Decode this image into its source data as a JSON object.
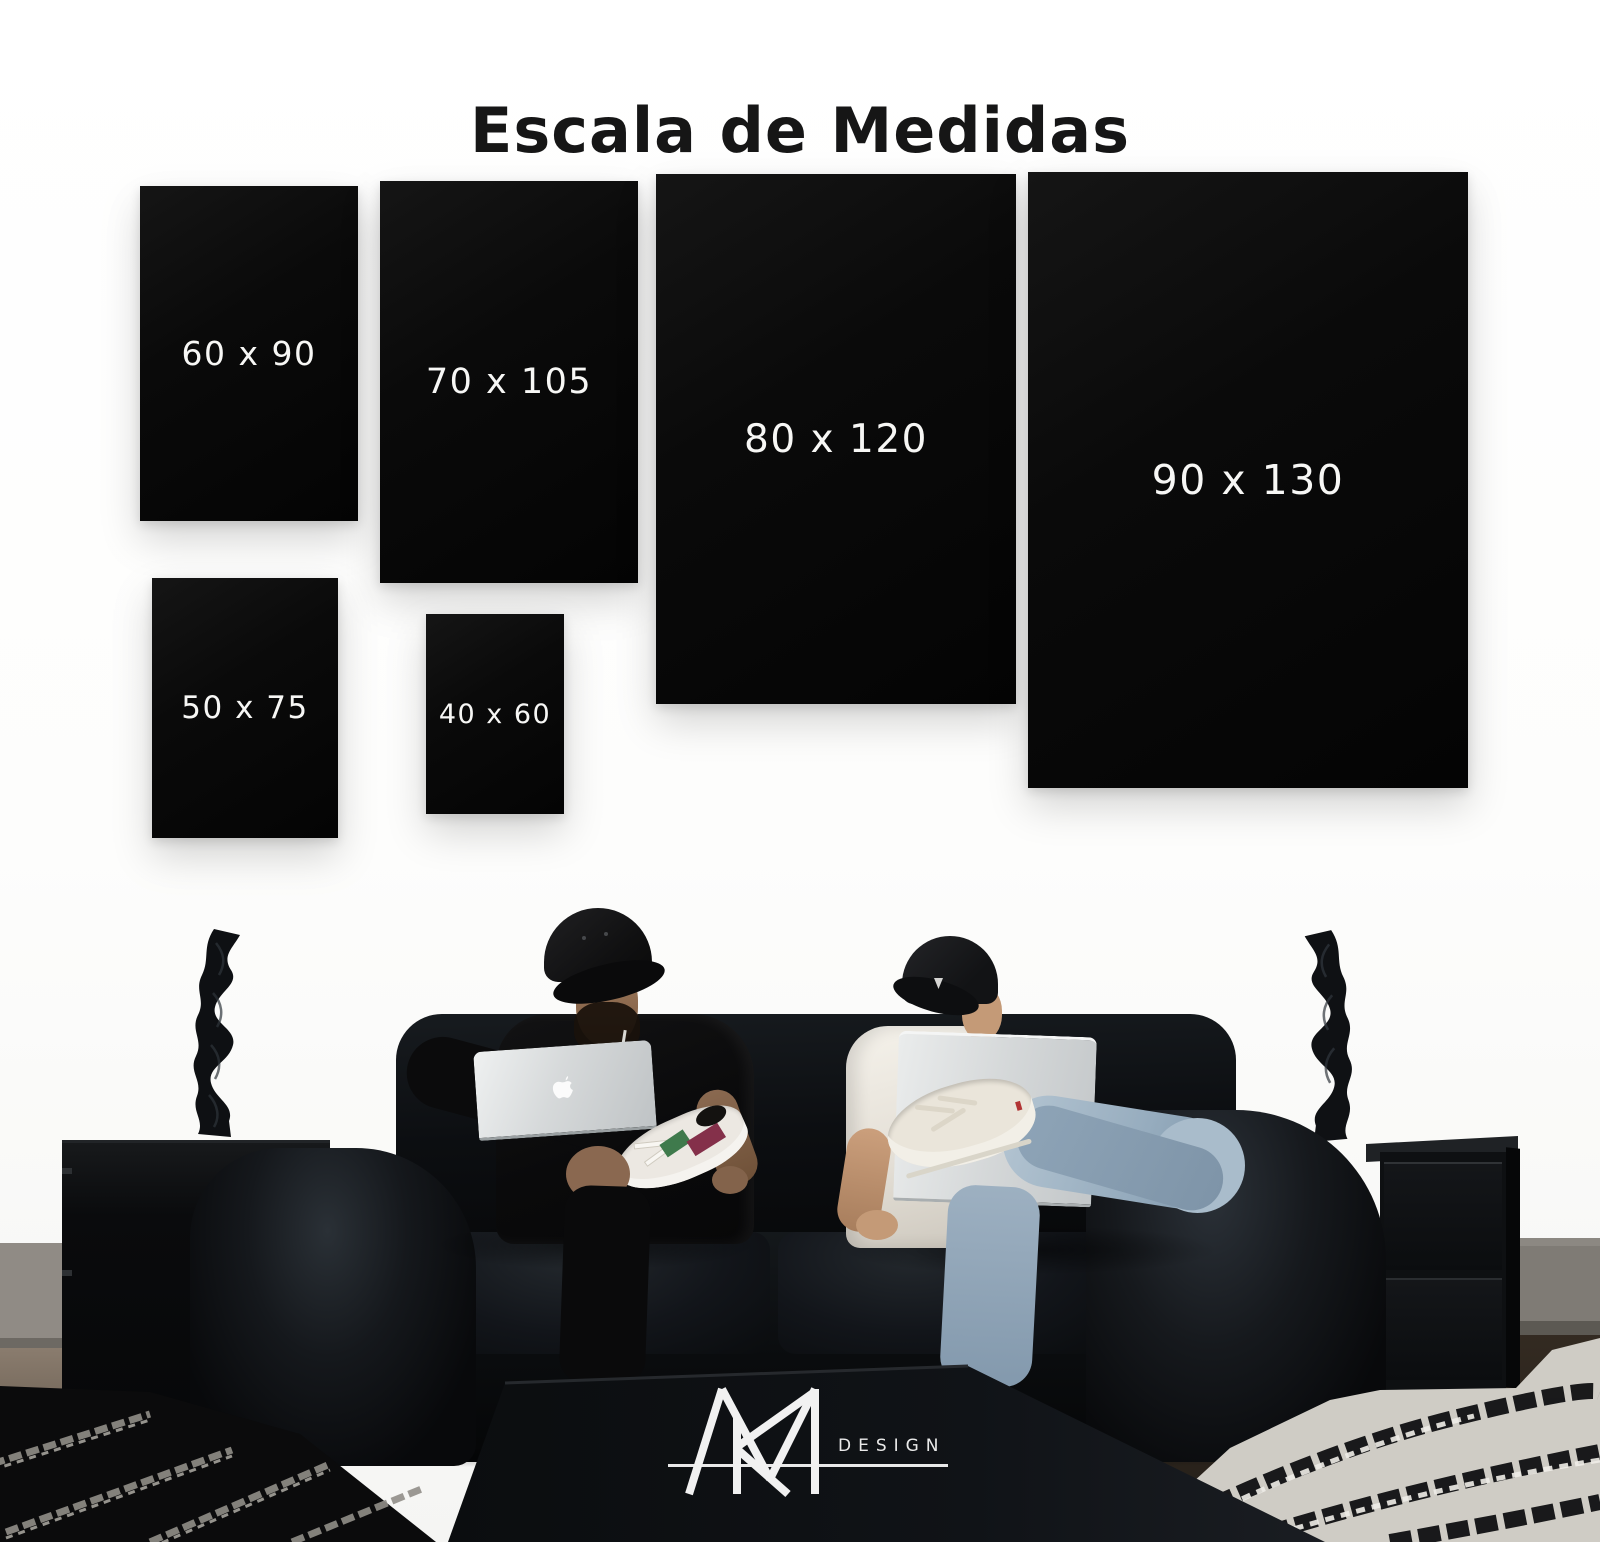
{
  "title": "Escala de Medidas",
  "sizes": [
    {
      "label": "60 x 90",
      "width_cm": 60,
      "height_cm": 90
    },
    {
      "label": "70 x 105",
      "width_cm": 70,
      "height_cm": 105
    },
    {
      "label": "80 x 120",
      "width_cm": 80,
      "height_cm": 120
    },
    {
      "label": "90 x 130",
      "width_cm": 90,
      "height_cm": 130
    },
    {
      "label": "50 x 75",
      "width_cm": 50,
      "height_cm": 75
    },
    {
      "label": "40 x 60",
      "width_cm": 40,
      "height_cm": 60
    }
  ],
  "brand": {
    "monogram": "MR",
    "wordmark": "DESIGN"
  },
  "colors": {
    "panel": "#0a0a0a",
    "label": "#f7f7f5",
    "title": "#161616",
    "logo": "#efefef"
  }
}
